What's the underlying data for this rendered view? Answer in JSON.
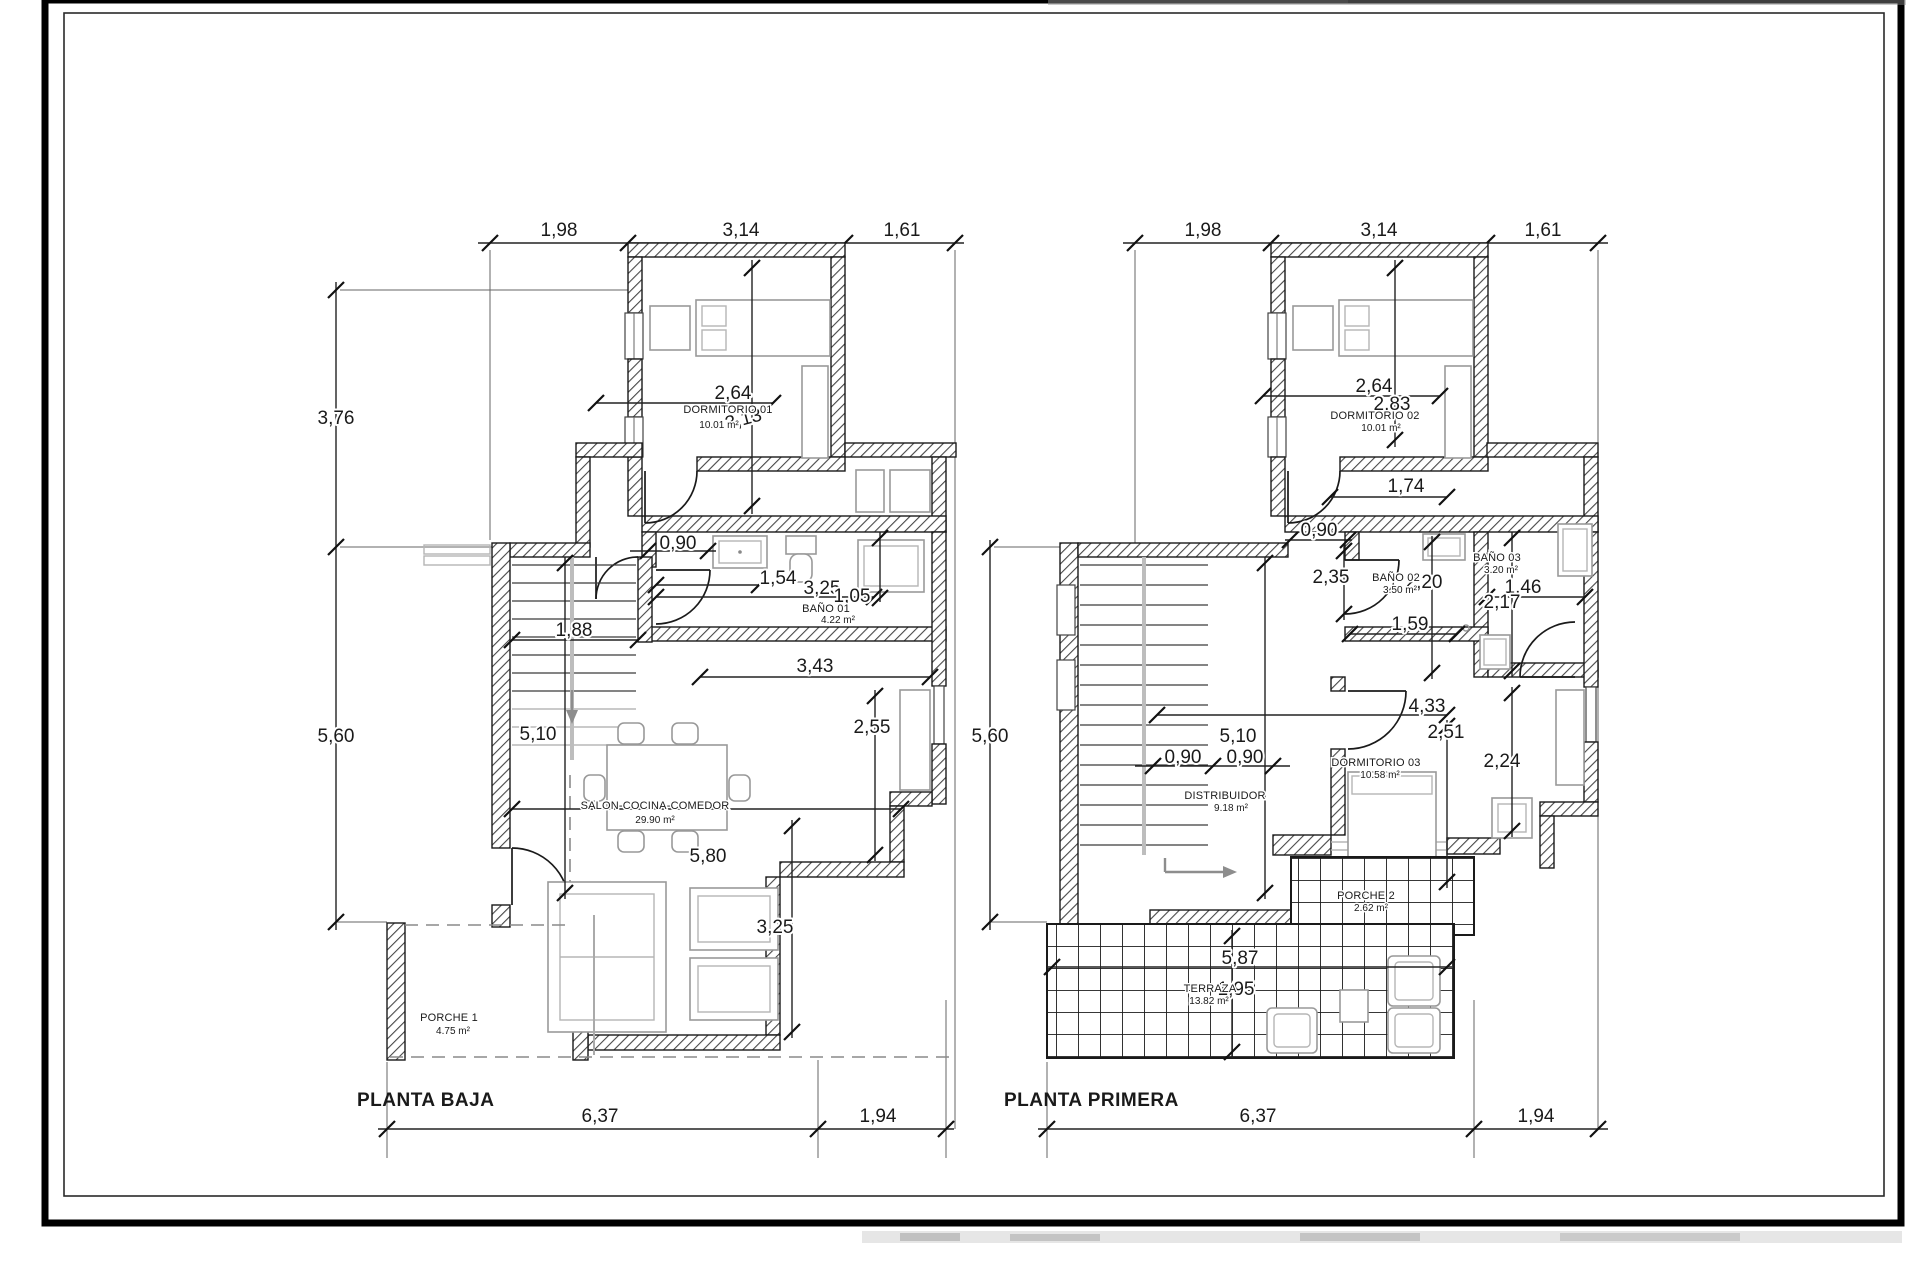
{
  "drawing": {
    "type": "architectural-floor-plan",
    "plans": [
      {
        "title": "PLANTA BAJA",
        "top_dims": [
          "1,98",
          "3,14",
          "1,61"
        ],
        "left_dims": [
          "3,76",
          "5,60"
        ],
        "bottom_dims": [
          "6,37",
          "1,94"
        ],
        "rooms": {
          "dormitorio01": {
            "name": "DORMITORIO 01",
            "area": "10.01 m²"
          },
          "bano01": {
            "name": "BAÑO 01",
            "area": "4.22 m²"
          },
          "salon": {
            "name": "SALON-COCINA-COMEDOR",
            "area": "29.90 m²"
          },
          "porche1": {
            "name": "PORCHE 1",
            "area": "4.75 m²"
          }
        },
        "d": {
          "v264": "2,64",
          "v313": "3,13",
          "v090": "0,90",
          "v154": "1,54",
          "v325": "3,25",
          "v105": "1,05",
          "v188": "1,88",
          "v510": "5,10",
          "v343": "3,43",
          "v255": "2,55",
          "v580": "5,80",
          "v325b": "3,25"
        }
      },
      {
        "title": "PLANTA PRIMERA",
        "top_dims": [
          "1,98",
          "3,14",
          "1,61"
        ],
        "left_dims": [
          "5,60"
        ],
        "bottom_dims": [
          "6,37",
          "1,94"
        ],
        "rooms": {
          "dormitorio02": {
            "name": "DORMITORIO 02",
            "area": "10.01 m²"
          },
          "bano02": {
            "name": "BAÑO 02",
            "area": "3.50 m²"
          },
          "bano03": {
            "name": "BAÑO 03",
            "area": "3.20 m²"
          },
          "dormitorio03": {
            "name": "DORMITORIO 03",
            "area": "10.58 m²"
          },
          "distribuidor": {
            "name": "DISTRIBUIDOR",
            "area": "9.18 m²"
          },
          "porche2": {
            "name": "PORCHE 2",
            "area": "2.62 m²"
          },
          "terraza": {
            "name": "TERRAZA",
            "area": "13.82 m²"
          }
        },
        "d": {
          "v264": "2,64",
          "v283": "2,83",
          "v174": "1,74",
          "v090": "0,90",
          "v090a": "0,90",
          "v090b": "0,90",
          "v235": "2,35",
          "v220": "2,20",
          "v217": "2,17",
          "v146": "1,46",
          "v159": "1,59",
          "v433": "4,33",
          "v251": "2,51",
          "v224": "2,24",
          "v510": "5,10",
          "v587": "5,87",
          "v195": "1,95"
        }
      }
    ]
  }
}
